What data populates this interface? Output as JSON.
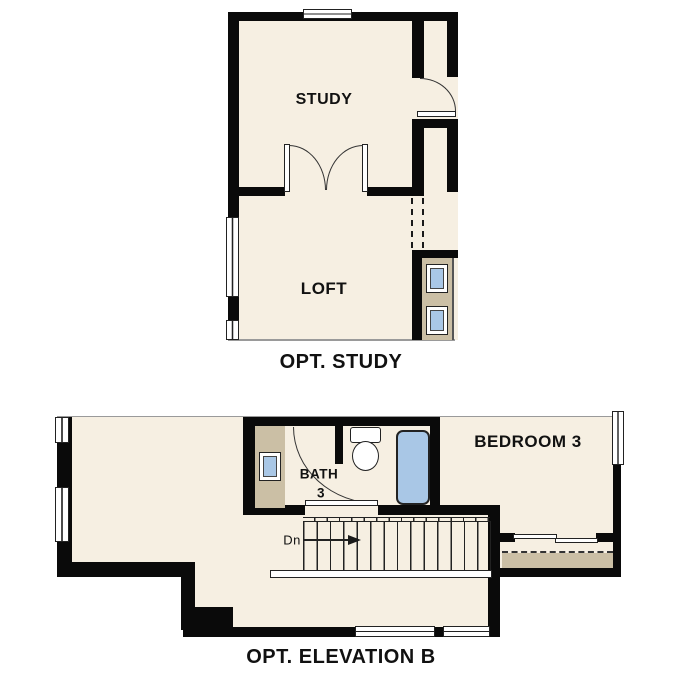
{
  "colors": {
    "floor": "#f6efe2",
    "wall": "#0a0a0a",
    "vanity_tan": "#cbbfa5",
    "fixture_blue": "#a9c7e6",
    "cut_line_gray": "#9a9a9a",
    "text": "#111111"
  },
  "plans": {
    "opt_study": {
      "caption": "OPT. STUDY",
      "rooms": {
        "study": "STUDY",
        "loft": "LOFT"
      }
    },
    "opt_elevation_b": {
      "caption": "OPT. ELEVATION B",
      "rooms": {
        "bath_line1": "BATH",
        "bath_line2": "3",
        "bedroom": "BEDROOM 3"
      },
      "stairs": {
        "direction_label": "Dn"
      }
    }
  }
}
